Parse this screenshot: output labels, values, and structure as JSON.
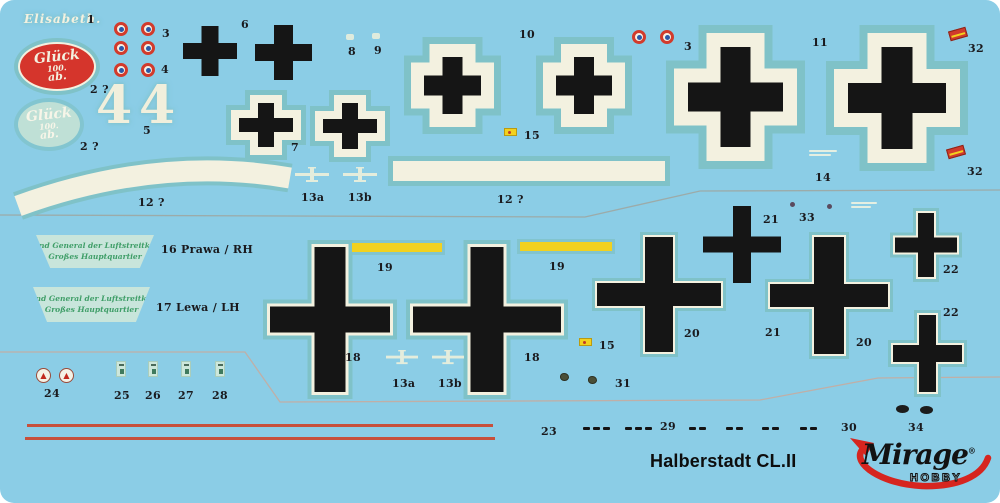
{
  "colors": {
    "background": "#8BCDE6",
    "film": "#7FC2C8",
    "cream": "#F3F1E0",
    "black": "#151515",
    "red_oval": "#D5352C",
    "roundel_red": "#D23B2C",
    "roundel_blue": "#2B58A8",
    "yellow": "#F2D11F",
    "stripe_red": "#C7503C",
    "green_text": "#3F9E68",
    "logo_red": "#D6251F",
    "line_grey": "#9FA49E"
  },
  "footer": {
    "title": "Halberstadt CL.II"
  },
  "brand": {
    "name": "Mirage",
    "reg": "®",
    "sub": "HOBBY"
  },
  "decals": {
    "elisabeth": "Elisabeth.",
    "glueck": {
      "l1": "Glück",
      "l2": "100.",
      "l3": "ab."
    },
    "big_numeral": "4",
    "kommand": {
      "l1": "Komnd General der Luftstreitkräfte",
      "l2": "Großes Hauptquartier"
    }
  },
  "labels": {
    "n1": "1",
    "n2a": "2 ?",
    "n2b": "2 ?",
    "n3a": "3",
    "n3b": "3",
    "n4": "4",
    "n5": "5",
    "n6": "6",
    "n7": "7",
    "n8": "8",
    "n9": "9",
    "n10": "10",
    "n11": "11",
    "n12a": "12 ?",
    "n12b": "12 ?",
    "n13a1": "13a",
    "n13b1": "13b",
    "n13a2": "13a",
    "n13b2": "13b",
    "n14": "14",
    "n15a": "15",
    "n15b": "15",
    "n16": "16  Prawa / RH",
    "n17": "17  Lewa / LH",
    "n18a": "18",
    "n18b": "18",
    "n19a": "19",
    "n19b": "19",
    "n20a": "20",
    "n20b": "20",
    "n21a": "21",
    "n21b": "21",
    "n22a": "22",
    "n22b": "22",
    "n23": "23",
    "n24": "24",
    "n25": "25",
    "n26": "26",
    "n27": "27",
    "n28": "28",
    "n29": "29",
    "n30": "30",
    "n31": "31",
    "n32a": "32",
    "n32b": "32",
    "n33": "33",
    "n34": "34"
  }
}
